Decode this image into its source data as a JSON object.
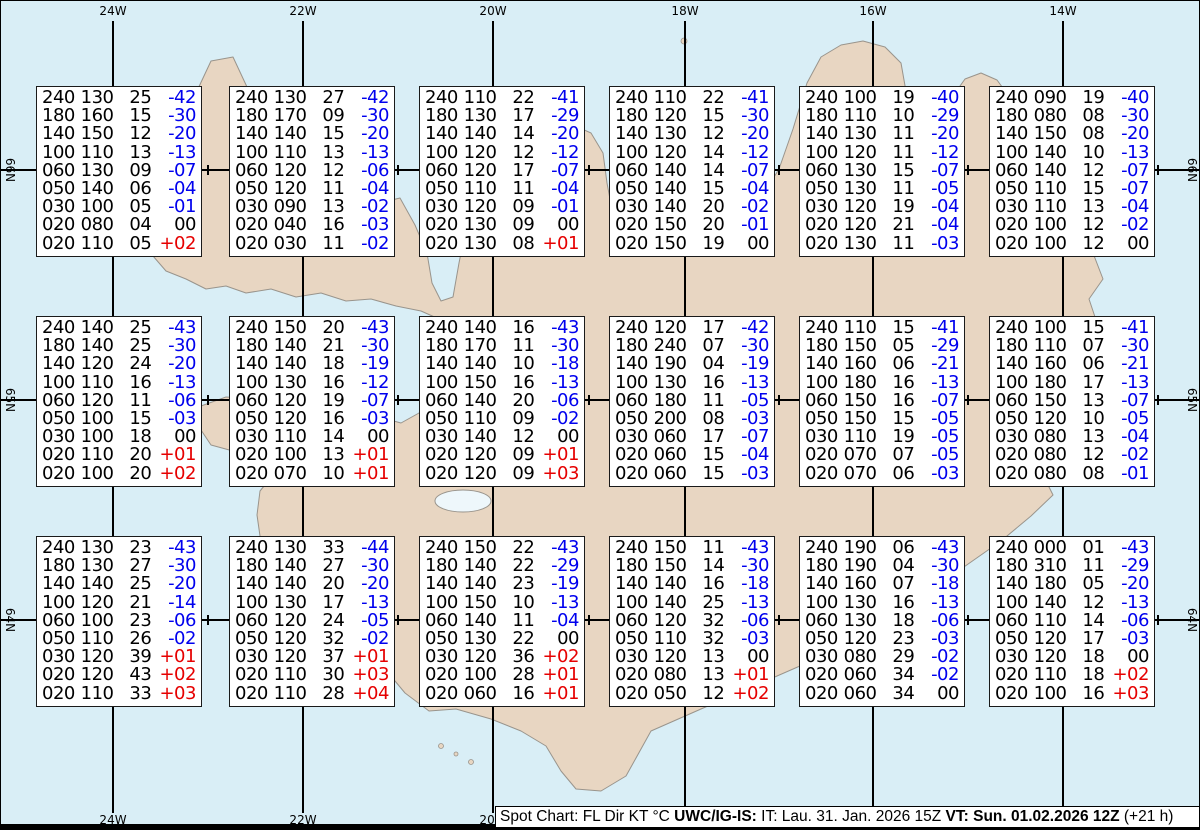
{
  "map": {
    "lon_labels": [
      "24W",
      "22W",
      "20W",
      "18W",
      "16W",
      "14W"
    ],
    "lat_labels": [
      "66N",
      "65N",
      "64N"
    ]
  },
  "caption": {
    "part1": "Spot Chart: FL Dir KT °C ",
    "part2": "UWC/IG-IS:",
    "part3": " IT: Lau. 31. Jan. 2026 15Z ",
    "part4": "VT: Sun. 01.02.2026 12Z",
    "part5": " (+21 h)"
  },
  "colors": {
    "sea": "#d9eef6",
    "land": "#e8d6c2",
    "coast": "#99948c",
    "grid": "#000000",
    "temp_negative": "#0000ee",
    "temp_positive": "#e60000"
  },
  "spot_boxes": [
    {
      "rows": [
        [
          "240",
          "130",
          "25",
          "-42"
        ],
        [
          "180",
          "160",
          "15",
          "-30"
        ],
        [
          "140",
          "150",
          "12",
          "-20"
        ],
        [
          "100",
          "110",
          "13",
          "-13"
        ],
        [
          "060",
          "130",
          "09",
          "-07"
        ],
        [
          "050",
          "140",
          "06",
          "-04"
        ],
        [
          "030",
          "100",
          "05",
          "-01"
        ],
        [
          "020",
          "080",
          "04",
          "00"
        ],
        [
          "020",
          "110",
          "05",
          "+02"
        ]
      ]
    },
    {
      "rows": [
        [
          "240",
          "130",
          "27",
          "-42"
        ],
        [
          "180",
          "170",
          "09",
          "-30"
        ],
        [
          "140",
          "140",
          "15",
          "-20"
        ],
        [
          "100",
          "110",
          "13",
          "-13"
        ],
        [
          "060",
          "120",
          "12",
          "-06"
        ],
        [
          "050",
          "120",
          "11",
          "-04"
        ],
        [
          "030",
          "090",
          "13",
          "-02"
        ],
        [
          "020",
          "040",
          "16",
          "-03"
        ],
        [
          "020",
          "030",
          "11",
          "-02"
        ]
      ]
    },
    {
      "rows": [
        [
          "240",
          "110",
          "22",
          "-41"
        ],
        [
          "180",
          "130",
          "17",
          "-29"
        ],
        [
          "140",
          "140",
          "14",
          "-20"
        ],
        [
          "100",
          "120",
          "12",
          "-12"
        ],
        [
          "060",
          "120",
          "17",
          "-07"
        ],
        [
          "050",
          "110",
          "11",
          "-04"
        ],
        [
          "030",
          "120",
          "09",
          "-01"
        ],
        [
          "020",
          "130",
          "09",
          "00"
        ],
        [
          "020",
          "130",
          "08",
          "+01"
        ]
      ]
    },
    {
      "rows": [
        [
          "240",
          "110",
          "22",
          "-41"
        ],
        [
          "180",
          "120",
          "15",
          "-30"
        ],
        [
          "140",
          "130",
          "12",
          "-20"
        ],
        [
          "100",
          "120",
          "14",
          "-12"
        ],
        [
          "060",
          "140",
          "14",
          "-07"
        ],
        [
          "050",
          "140",
          "15",
          "-04"
        ],
        [
          "030",
          "140",
          "20",
          "-02"
        ],
        [
          "020",
          "150",
          "20",
          "-01"
        ],
        [
          "020",
          "150",
          "19",
          "00"
        ]
      ]
    },
    {
      "rows": [
        [
          "240",
          "100",
          "19",
          "-40"
        ],
        [
          "180",
          "110",
          "10",
          "-29"
        ],
        [
          "140",
          "130",
          "11",
          "-20"
        ],
        [
          "100",
          "120",
          "11",
          "-12"
        ],
        [
          "060",
          "130",
          "15",
          "-07"
        ],
        [
          "050",
          "130",
          "11",
          "-05"
        ],
        [
          "030",
          "120",
          "19",
          "-04"
        ],
        [
          "020",
          "120",
          "21",
          "-04"
        ],
        [
          "020",
          "130",
          "11",
          "-03"
        ]
      ]
    },
    {
      "rows": [
        [
          "240",
          "090",
          "19",
          "-40"
        ],
        [
          "180",
          "080",
          "08",
          "-30"
        ],
        [
          "140",
          "150",
          "08",
          "-20"
        ],
        [
          "100",
          "140",
          "10",
          "-13"
        ],
        [
          "060",
          "140",
          "12",
          "-07"
        ],
        [
          "050",
          "110",
          "15",
          "-07"
        ],
        [
          "030",
          "110",
          "13",
          "-04"
        ],
        [
          "020",
          "100",
          "12",
          "-02"
        ],
        [
          "020",
          "100",
          "12",
          "00"
        ]
      ]
    },
    {
      "rows": [
        [
          "240",
          "140",
          "25",
          "-43"
        ],
        [
          "180",
          "140",
          "25",
          "-30"
        ],
        [
          "140",
          "120",
          "24",
          "-20"
        ],
        [
          "100",
          "110",
          "16",
          "-13"
        ],
        [
          "060",
          "120",
          "11",
          "-06"
        ],
        [
          "050",
          "100",
          "15",
          "-03"
        ],
        [
          "030",
          "100",
          "18",
          "00"
        ],
        [
          "020",
          "110",
          "20",
          "+01"
        ],
        [
          "020",
          "100",
          "20",
          "+02"
        ]
      ]
    },
    {
      "rows": [
        [
          "240",
          "150",
          "20",
          "-43"
        ],
        [
          "180",
          "140",
          "21",
          "-30"
        ],
        [
          "140",
          "140",
          "18",
          "-19"
        ],
        [
          "100",
          "130",
          "16",
          "-12"
        ],
        [
          "060",
          "120",
          "19",
          "-07"
        ],
        [
          "050",
          "120",
          "16",
          "-03"
        ],
        [
          "030",
          "110",
          "14",
          "00"
        ],
        [
          "020",
          "100",
          "13",
          "+01"
        ],
        [
          "020",
          "070",
          "10",
          "+01"
        ]
      ]
    },
    {
      "rows": [
        [
          "240",
          "140",
          "16",
          "-43"
        ],
        [
          "180",
          "170",
          "11",
          "-30"
        ],
        [
          "140",
          "140",
          "10",
          "-18"
        ],
        [
          "100",
          "150",
          "16",
          "-13"
        ],
        [
          "060",
          "140",
          "20",
          "-06"
        ],
        [
          "050",
          "110",
          "09",
          "-02"
        ],
        [
          "030",
          "140",
          "12",
          "00"
        ],
        [
          "020",
          "120",
          "09",
          "+01"
        ],
        [
          "020",
          "120",
          "09",
          "+03"
        ]
      ]
    },
    {
      "rows": [
        [
          "240",
          "120",
          "17",
          "-42"
        ],
        [
          "180",
          "240",
          "07",
          "-30"
        ],
        [
          "140",
          "190",
          "04",
          "-19"
        ],
        [
          "100",
          "130",
          "16",
          "-13"
        ],
        [
          "060",
          "180",
          "11",
          "-05"
        ],
        [
          "050",
          "200",
          "08",
          "-03"
        ],
        [
          "030",
          "060",
          "17",
          "-07"
        ],
        [
          "020",
          "060",
          "15",
          "-04"
        ],
        [
          "020",
          "060",
          "15",
          "-03"
        ]
      ]
    },
    {
      "rows": [
        [
          "240",
          "110",
          "15",
          "-41"
        ],
        [
          "180",
          "150",
          "05",
          "-29"
        ],
        [
          "140",
          "160",
          "06",
          "-21"
        ],
        [
          "100",
          "180",
          "16",
          "-13"
        ],
        [
          "060",
          "150",
          "16",
          "-07"
        ],
        [
          "050",
          "150",
          "15",
          "-05"
        ],
        [
          "030",
          "110",
          "19",
          "-05"
        ],
        [
          "020",
          "070",
          "07",
          "-05"
        ],
        [
          "020",
          "070",
          "06",
          "-03"
        ]
      ]
    },
    {
      "rows": [
        [
          "240",
          "100",
          "15",
          "-41"
        ],
        [
          "180",
          "110",
          "07",
          "-30"
        ],
        [
          "140",
          "160",
          "06",
          "-21"
        ],
        [
          "100",
          "180",
          "17",
          "-13"
        ],
        [
          "060",
          "150",
          "13",
          "-07"
        ],
        [
          "050",
          "120",
          "10",
          "-05"
        ],
        [
          "030",
          "080",
          "13",
          "-04"
        ],
        [
          "020",
          "080",
          "12",
          "-02"
        ],
        [
          "020",
          "080",
          "08",
          "-01"
        ]
      ]
    },
    {
      "rows": [
        [
          "240",
          "130",
          "23",
          "-43"
        ],
        [
          "180",
          "130",
          "27",
          "-30"
        ],
        [
          "140",
          "140",
          "25",
          "-20"
        ],
        [
          "100",
          "120",
          "21",
          "-14"
        ],
        [
          "060",
          "100",
          "23",
          "-06"
        ],
        [
          "050",
          "110",
          "26",
          "-02"
        ],
        [
          "030",
          "120",
          "39",
          "+01"
        ],
        [
          "020",
          "120",
          "43",
          "+02"
        ],
        [
          "020",
          "110",
          "33",
          "+03"
        ]
      ]
    },
    {
      "rows": [
        [
          "240",
          "130",
          "33",
          "-44"
        ],
        [
          "180",
          "140",
          "27",
          "-30"
        ],
        [
          "140",
          "140",
          "20",
          "-20"
        ],
        [
          "100",
          "130",
          "17",
          "-13"
        ],
        [
          "060",
          "120",
          "24",
          "-05"
        ],
        [
          "050",
          "120",
          "32",
          "-02"
        ],
        [
          "030",
          "120",
          "37",
          "+01"
        ],
        [
          "020",
          "110",
          "30",
          "+03"
        ],
        [
          "020",
          "110",
          "28",
          "+04"
        ]
      ]
    },
    {
      "rows": [
        [
          "240",
          "150",
          "22",
          "-43"
        ],
        [
          "180",
          "140",
          "22",
          "-29"
        ],
        [
          "140",
          "140",
          "23",
          "-19"
        ],
        [
          "100",
          "150",
          "10",
          "-13"
        ],
        [
          "060",
          "140",
          "11",
          "-04"
        ],
        [
          "050",
          "130",
          "22",
          "00"
        ],
        [
          "030",
          "120",
          "36",
          "+02"
        ],
        [
          "020",
          "100",
          "28",
          "+01"
        ],
        [
          "020",
          "060",
          "16",
          "+01"
        ]
      ]
    },
    {
      "rows": [
        [
          "240",
          "150",
          "11",
          "-43"
        ],
        [
          "180",
          "150",
          "14",
          "-30"
        ],
        [
          "140",
          "140",
          "16",
          "-18"
        ],
        [
          "100",
          "140",
          "25",
          "-13"
        ],
        [
          "060",
          "120",
          "32",
          "-06"
        ],
        [
          "050",
          "110",
          "32",
          "-03"
        ],
        [
          "030",
          "120",
          "13",
          "00"
        ],
        [
          "020",
          "080",
          "13",
          "+01"
        ],
        [
          "020",
          "050",
          "12",
          "+02"
        ]
      ]
    },
    {
      "rows": [
        [
          "240",
          "190",
          "06",
          "-43"
        ],
        [
          "180",
          "190",
          "04",
          "-30"
        ],
        [
          "140",
          "160",
          "07",
          "-18"
        ],
        [
          "100",
          "130",
          "16",
          "-13"
        ],
        [
          "060",
          "130",
          "18",
          "-06"
        ],
        [
          "050",
          "120",
          "23",
          "-03"
        ],
        [
          "030",
          "080",
          "29",
          "-02"
        ],
        [
          "020",
          "060",
          "34",
          "-02"
        ],
        [
          "020",
          "060",
          "34",
          "00"
        ]
      ]
    },
    {
      "rows": [
        [
          "240",
          "000",
          "01",
          "-43"
        ],
        [
          "180",
          "310",
          "11",
          "-29"
        ],
        [
          "140",
          "180",
          "05",
          "-20"
        ],
        [
          "100",
          "140",
          "12",
          "-13"
        ],
        [
          "060",
          "110",
          "14",
          "-06"
        ],
        [
          "050",
          "120",
          "17",
          "-03"
        ],
        [
          "030",
          "120",
          "18",
          "00"
        ],
        [
          "020",
          "110",
          "18",
          "+02"
        ],
        [
          "020",
          "100",
          "16",
          "+03"
        ]
      ]
    }
  ]
}
